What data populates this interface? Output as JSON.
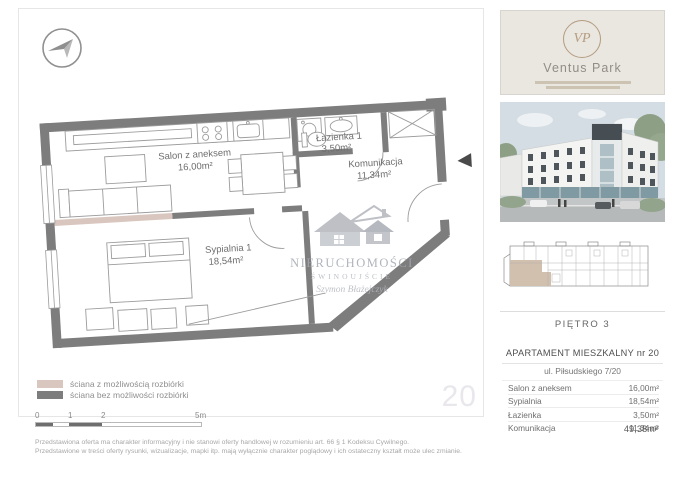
{
  "document": {
    "page_number_badge": "20",
    "footer_disclaimer_line1": "Przedstawiona oferta ma charakter informacyjny i nie stanowi oferty handlowej w rozumieniu art. 66 § 1 Kodeksu Cywilnego.",
    "footer_disclaimer_line2": "Przedstawione w treści oferty rysunki, wizualizacje, mapki itp. mają wyłącznie charakter poglądowy i ich ostateczny kształt może ulec zmianie."
  },
  "floorplan": {
    "rooms": [
      {
        "label": "Salon z aneksem",
        "area": "16,00m²"
      },
      {
        "label": "Łazienka 1",
        "area": "3,50m²"
      },
      {
        "label": "Komunikacja",
        "area": "11,34m²"
      },
      {
        "label": "Sypialnia 1",
        "area": "18,54m²"
      }
    ],
    "legend": [
      {
        "label": "ściana z możliwością rozbiórki",
        "swatch": "#d9c6bf"
      },
      {
        "label": "ściana bez możliwości rozbiórki",
        "swatch": "#7d7d7d"
      }
    ],
    "scale_ticks": [
      "0",
      "1",
      "2",
      "5m"
    ],
    "watermark": {
      "line1": "NIERUCHOMOŚCI",
      "line2": "ŚWINOUJŚCIE",
      "signature": "Szymon Błażejczyk"
    }
  },
  "sidebar": {
    "brand": {
      "name": "Ventus Park",
      "monogram": "VP"
    },
    "floor_label": "PIĘTRO 3",
    "apartment": {
      "title": "APARTAMENT MIESZKALNY nr 20",
      "address": "ul. Piłsudskiego 7/20",
      "rows": [
        {
          "name": "Salon z aneksem",
          "value": "16,00m²"
        },
        {
          "name": "Sypialnia",
          "value": "18,54m²"
        },
        {
          "name": "Łazienka",
          "value": "3,50m²"
        },
        {
          "name": "Komunikacja",
          "value": "11,34m²"
        }
      ],
      "total": "49,38m²"
    }
  },
  "colors": {
    "wall": "#7d7d7d",
    "demolishable_wall": "#d9c6bf",
    "accent_gold": "#b49c80",
    "highlight_unit": "#d2c0ae"
  }
}
